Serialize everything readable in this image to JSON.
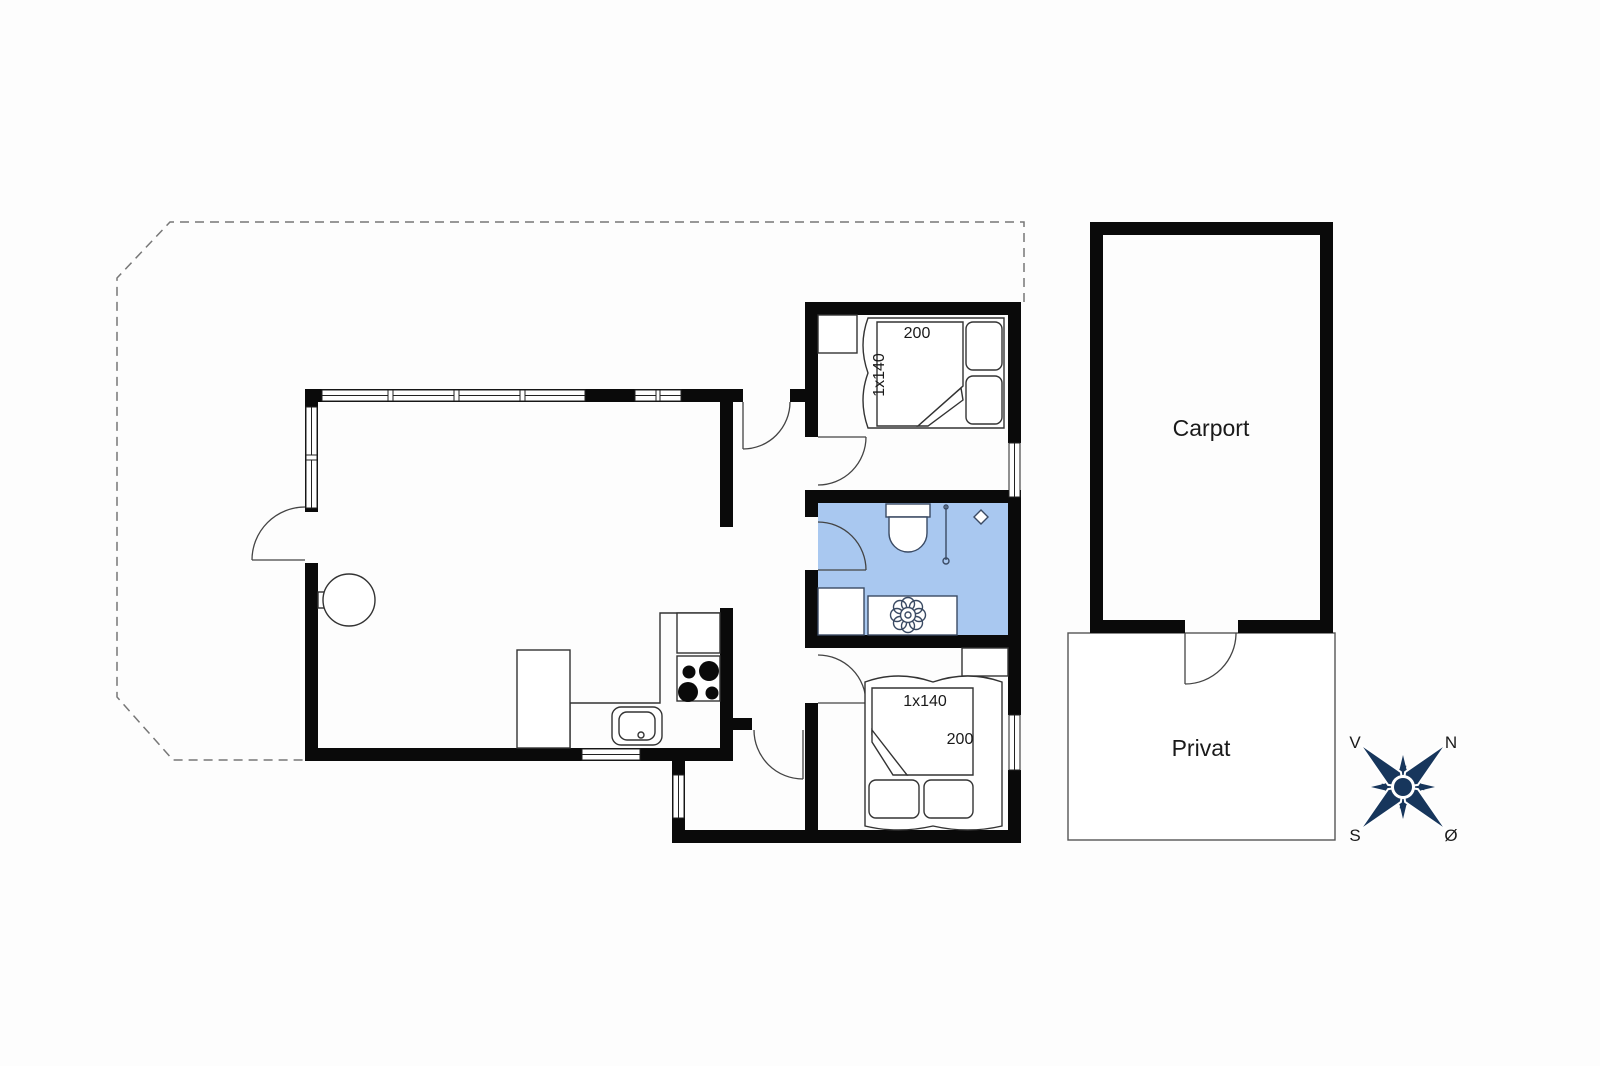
{
  "plan": {
    "labels": {
      "carport": "Carport",
      "privat": "Privat"
    },
    "bedroom_top": {
      "bed_length": "200",
      "bed_size": "1x140"
    },
    "bedroom_bottom": {
      "bed_size": "1x140",
      "bed_length": "200"
    },
    "compass": {
      "west": "V",
      "north": "N",
      "south": "S",
      "east": "Ø"
    },
    "colors": {
      "wall": "#0a0a0a",
      "bathroom_floor": "#a9c8f0",
      "compass_navy": "#17365c"
    }
  }
}
